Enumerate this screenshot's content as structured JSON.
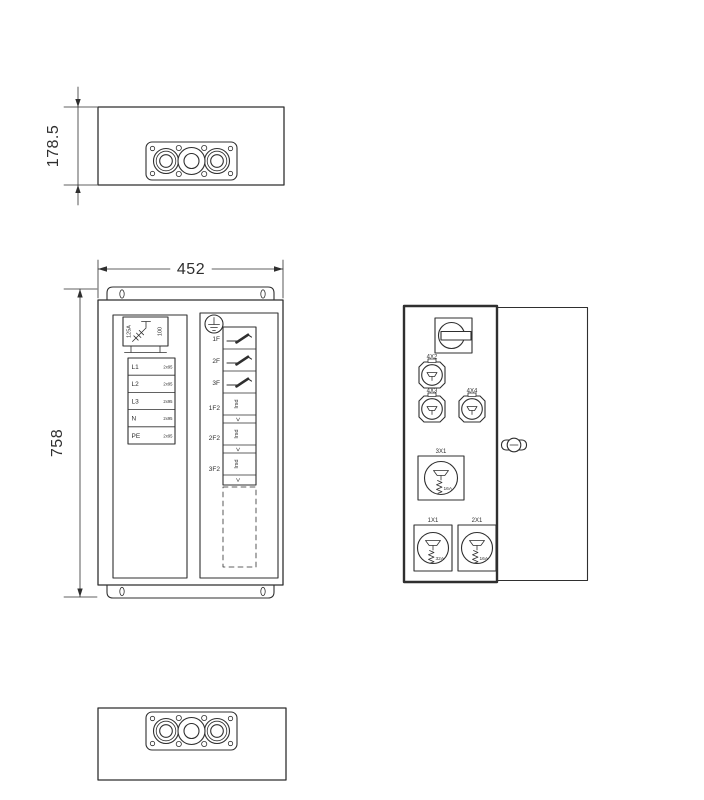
{
  "colors": {
    "line": "#2f2f2f",
    "background": "#ffffff"
  },
  "dimensions": {
    "depth": "178.5",
    "width": "452",
    "height": "758"
  },
  "front_view": {
    "main_switch": {
      "rating": "125A",
      "frame": "100"
    },
    "terminals": [
      {
        "label": "L1",
        "size": "2x95"
      },
      {
        "label": "L2",
        "size": "2x95"
      },
      {
        "label": "L3",
        "size": "2x95"
      },
      {
        "label": "N",
        "size": "2x95"
      },
      {
        "label": "PE",
        "size": "2x95"
      }
    ],
    "feeders": [
      {
        "label": "1F"
      },
      {
        "label": "2F"
      },
      {
        "label": "3F"
      }
    ],
    "rcds": [
      {
        "label": "1F2",
        "marking": "Irsd",
        "arrow": "<"
      },
      {
        "label": "2F2",
        "marking": "Irsd",
        "arrow": "<"
      },
      {
        "label": "3F2",
        "marking": "Irsd",
        "arrow": "<"
      }
    ]
  },
  "side_view": {
    "small_sockets": [
      {
        "id": "4X2"
      },
      {
        "id": "4X3"
      },
      {
        "id": "4X4"
      }
    ],
    "cee_sockets": [
      {
        "id": "3X1",
        "rating": "16A"
      },
      {
        "id": "1X1",
        "rating": "32A"
      },
      {
        "id": "2X1",
        "rating": "16A"
      }
    ]
  }
}
